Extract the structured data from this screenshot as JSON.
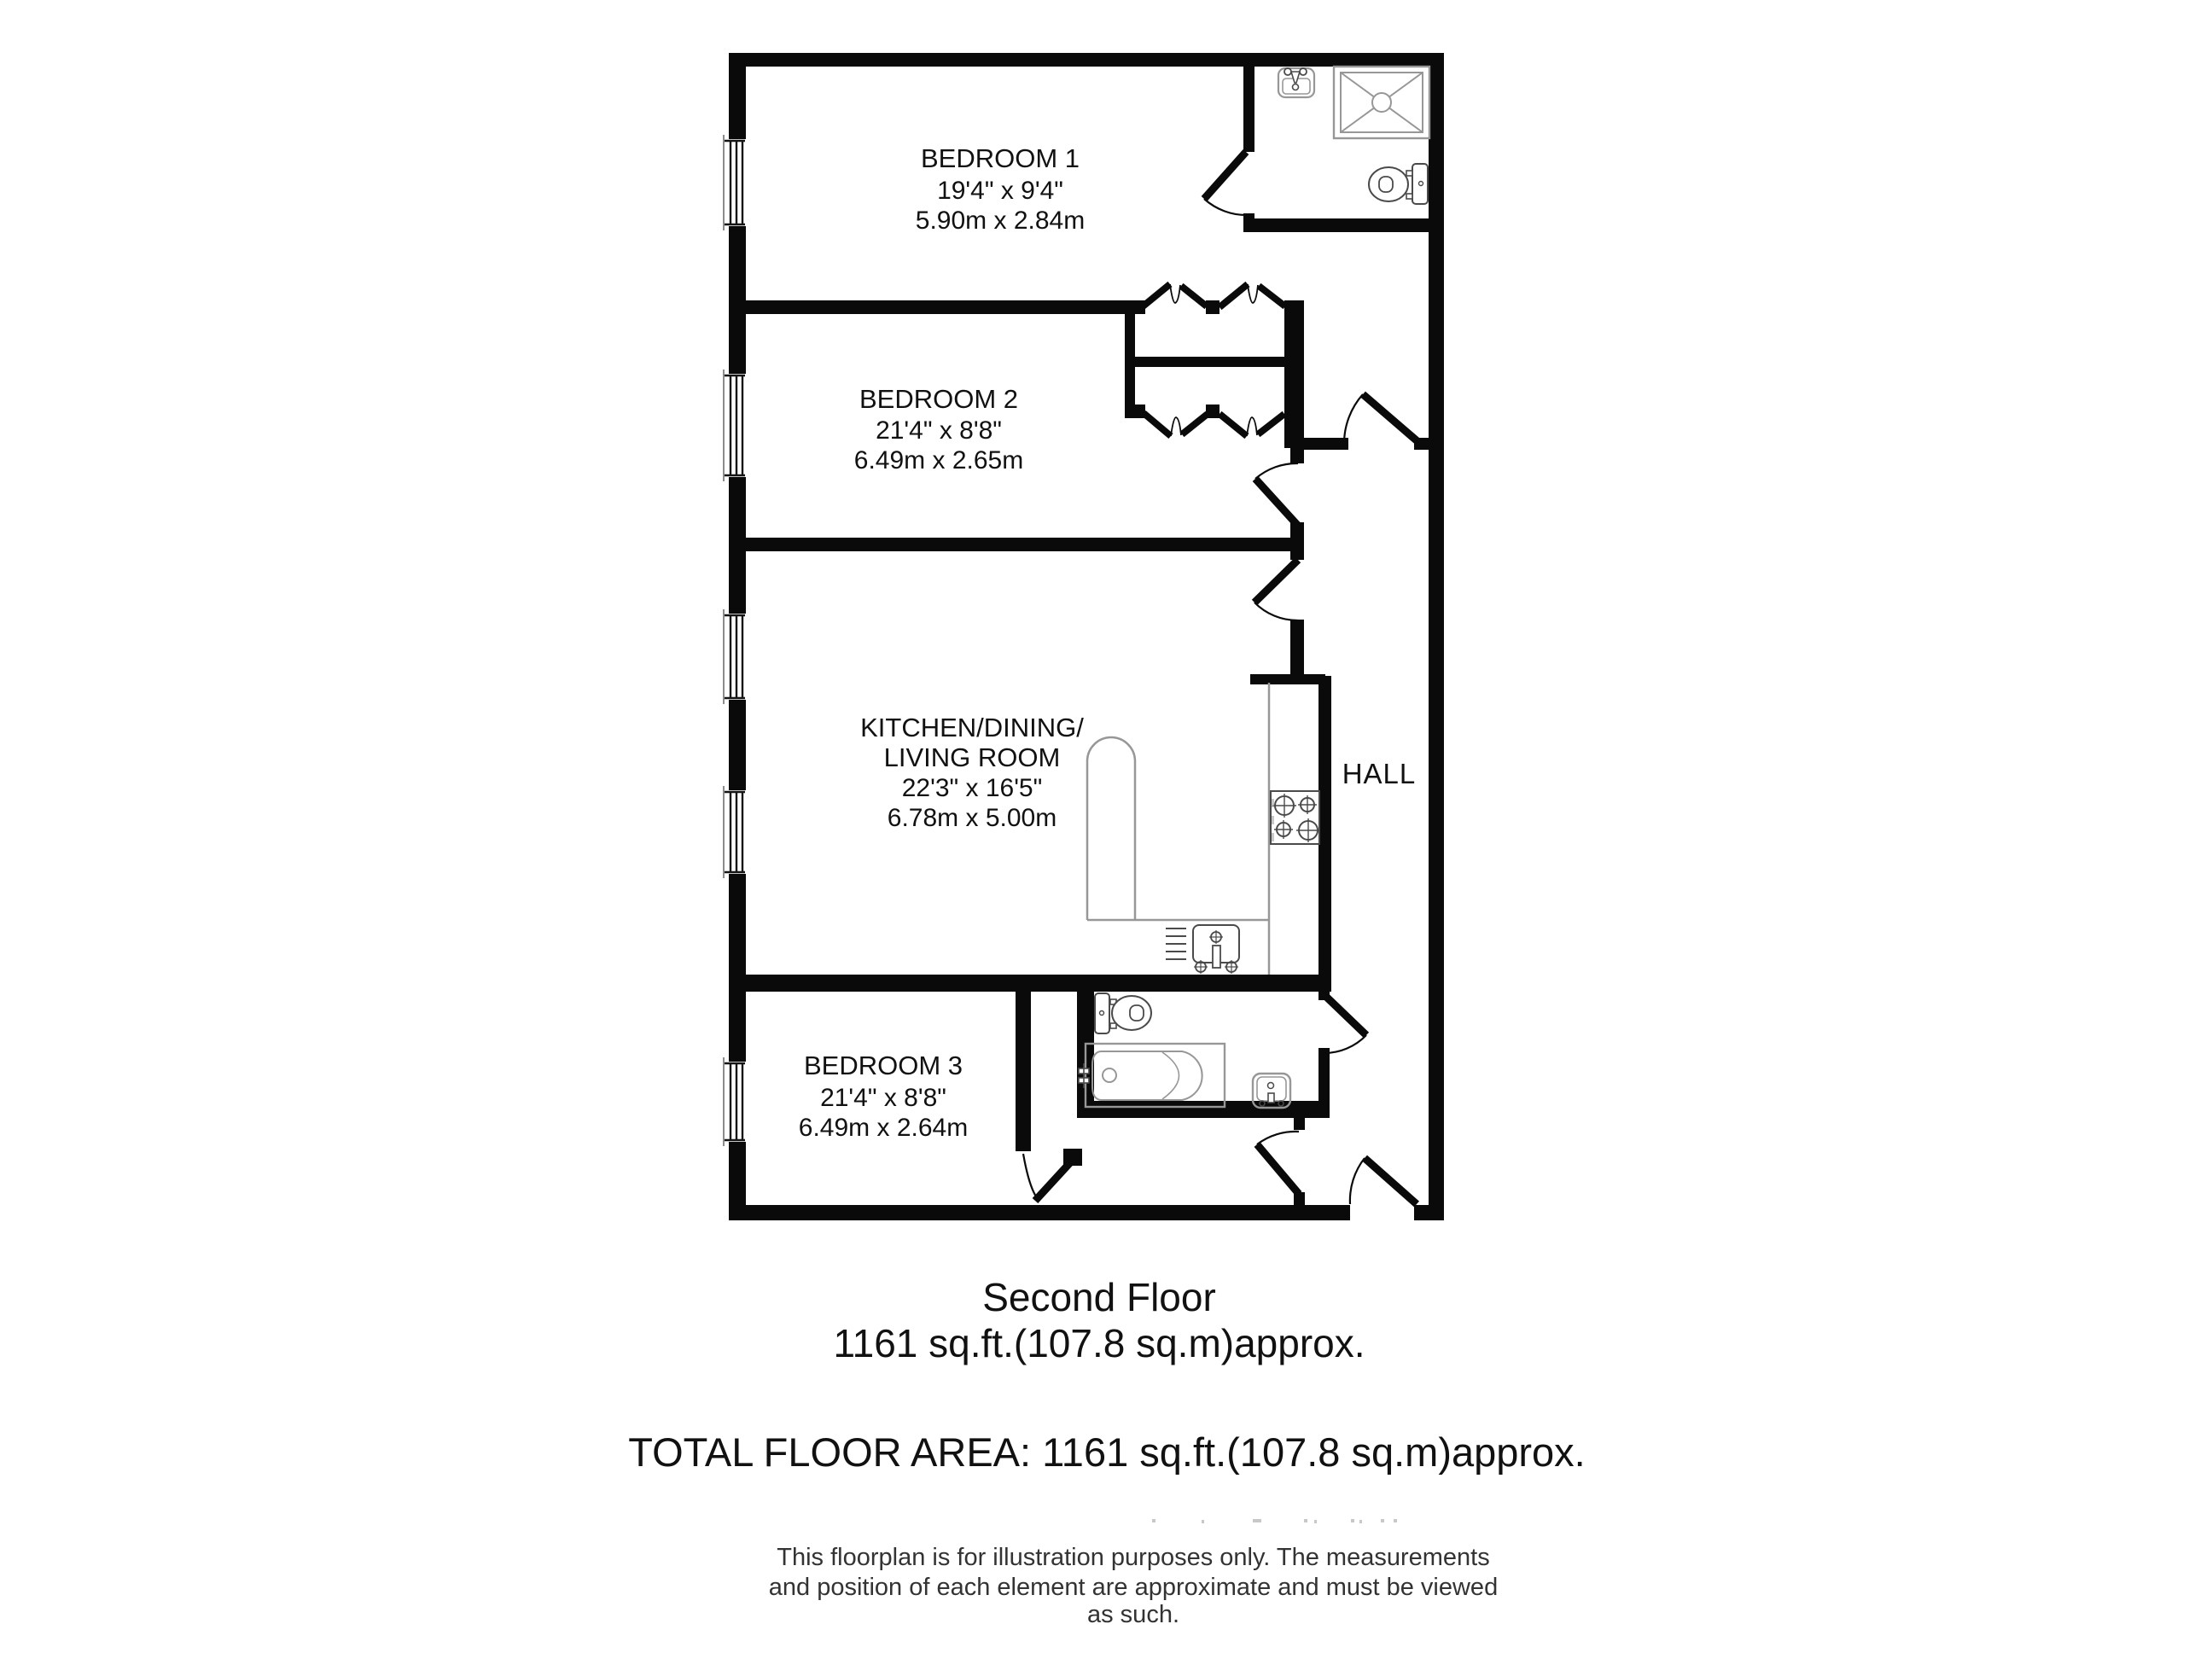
{
  "floorplan": {
    "rooms": {
      "bedroom1": {
        "name": "BEDROOM 1",
        "size_imperial": "19'4\" x 9'4\"",
        "size_metric": "5.90m x 2.84m"
      },
      "bedroom2": {
        "name": "BEDROOM 2",
        "size_imperial": "21'4\" x 8'8\"",
        "size_metric": "6.49m x 2.65m"
      },
      "kitchen_living": {
        "name_line1": "KITCHEN/DINING/",
        "name_line2": "LIVING ROOM",
        "size_imperial": "22'3\" x 16'5\"",
        "size_metric": "6.78m x 5.00m"
      },
      "hall": {
        "name": "HALL"
      },
      "bedroom3": {
        "name": "BEDROOM 3",
        "size_imperial": "21'4\" x 8'8\"",
        "size_metric": "6.49m x 2.64m"
      }
    },
    "fixtures": {
      "ensuite": [
        "sink",
        "shower",
        "toilet"
      ],
      "bathroom": [
        "toilet",
        "bath",
        "sink"
      ],
      "kitchen": [
        "counter",
        "hob",
        "sink"
      ],
      "wardrobes": [
        "bifold-doors-bedroom1",
        "bifold-doors-bedroom2"
      ]
    }
  },
  "footer": {
    "floor_name": "Second Floor",
    "floor_area": "1161 sq.ft.(107.8 sq.m)approx.",
    "total_area": "TOTAL FLOOR AREA: 1161 sq.ft.(107.8 sq.m)approx.",
    "disclaimer": [
      "This floorplan is for illustration purposes only. The measurements",
      "and position of each element are approximate and must be viewed",
      "as such."
    ]
  },
  "colors": {
    "wall": "#0a0a0a",
    "fixture_light": "#979797",
    "fixture_dark": "#4a4a4a",
    "text": "#111111",
    "background": "#ffffff"
  }
}
